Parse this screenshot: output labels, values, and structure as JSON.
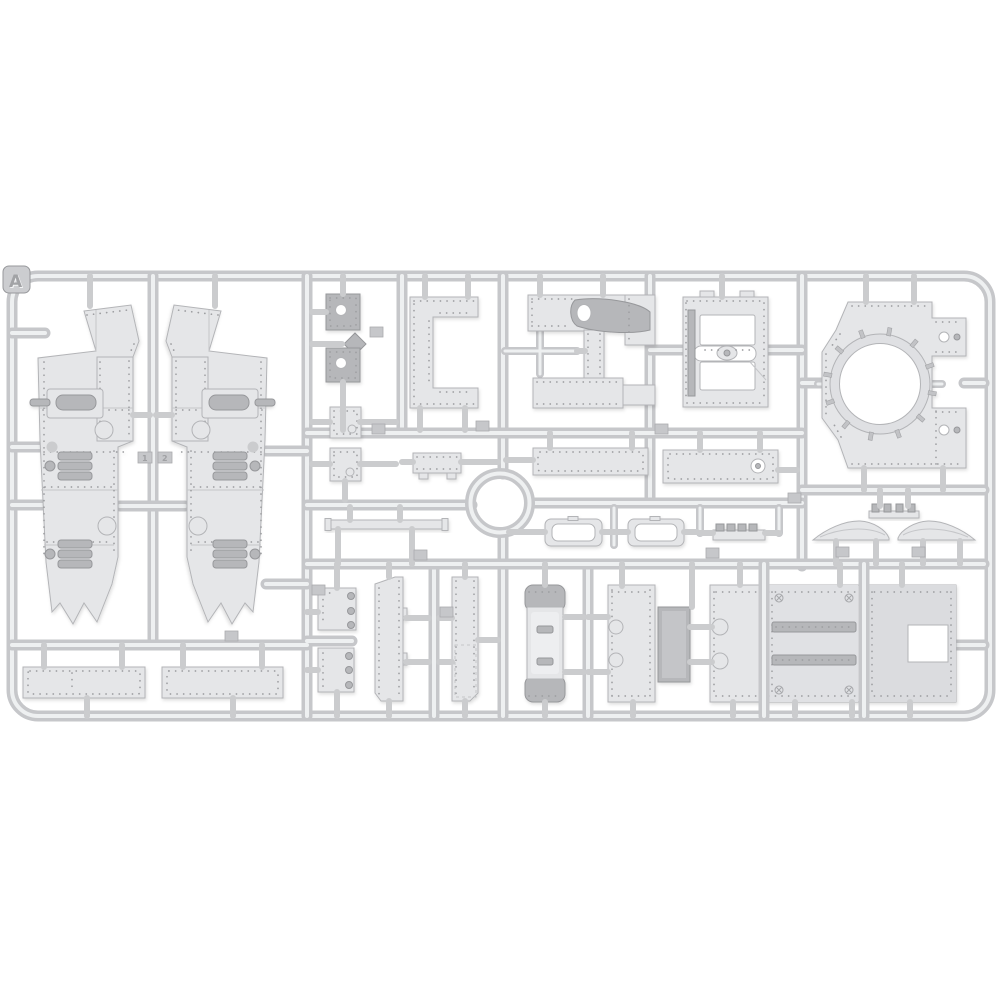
{
  "image": {
    "kind": "product-photo",
    "subject": "injection-molded plastic model kit sprue with riveted tank hull parts",
    "background": "#ffffff"
  },
  "sprue": {
    "label": "A",
    "tags": [
      "1",
      "2"
    ]
  },
  "colors": {
    "bg": "#ffffff",
    "runnerBase": "#c6c7ca",
    "runnerHi": "#eef0f1",
    "pin": "#cbccce",
    "partFill": "#e5e6e8",
    "partStroke": "#b3b4b7",
    "partDark": "#b6b7ba",
    "rivet": "#9d9ea1",
    "seam": "#c5c6c9",
    "tagFill": "#c6c7ca",
    "labelText": "#a2a3a6"
  },
  "parts": [
    "hull-side-panel-left",
    "hull-side-panel-right",
    "floor-strip-1",
    "floor-strip-2",
    "mount-plate-dark-1",
    "mount-plate-dark-2",
    "mount-plate-light-1",
    "mount-plate-light-2",
    "c-shaped-bracket",
    "small-footed-plate",
    "exhaust-cowl-panel",
    "riveted-beam-1",
    "riveted-beam-2",
    "mg-hatch-plate",
    "turret-ring-plate",
    "thin-strip",
    "oval-frame-1",
    "oval-frame-2",
    "comb-rail",
    "teeth-bracket",
    "airfoil-fairing-left",
    "airfoil-fairing-right",
    "square-plate-1",
    "square-plate-2",
    "narrow-panel-1",
    "narrow-panel-2",
    "fuel-drum",
    "sponson-plate",
    "roof-plate-left",
    "roof-plate-center",
    "roof-plate-right"
  ]
}
